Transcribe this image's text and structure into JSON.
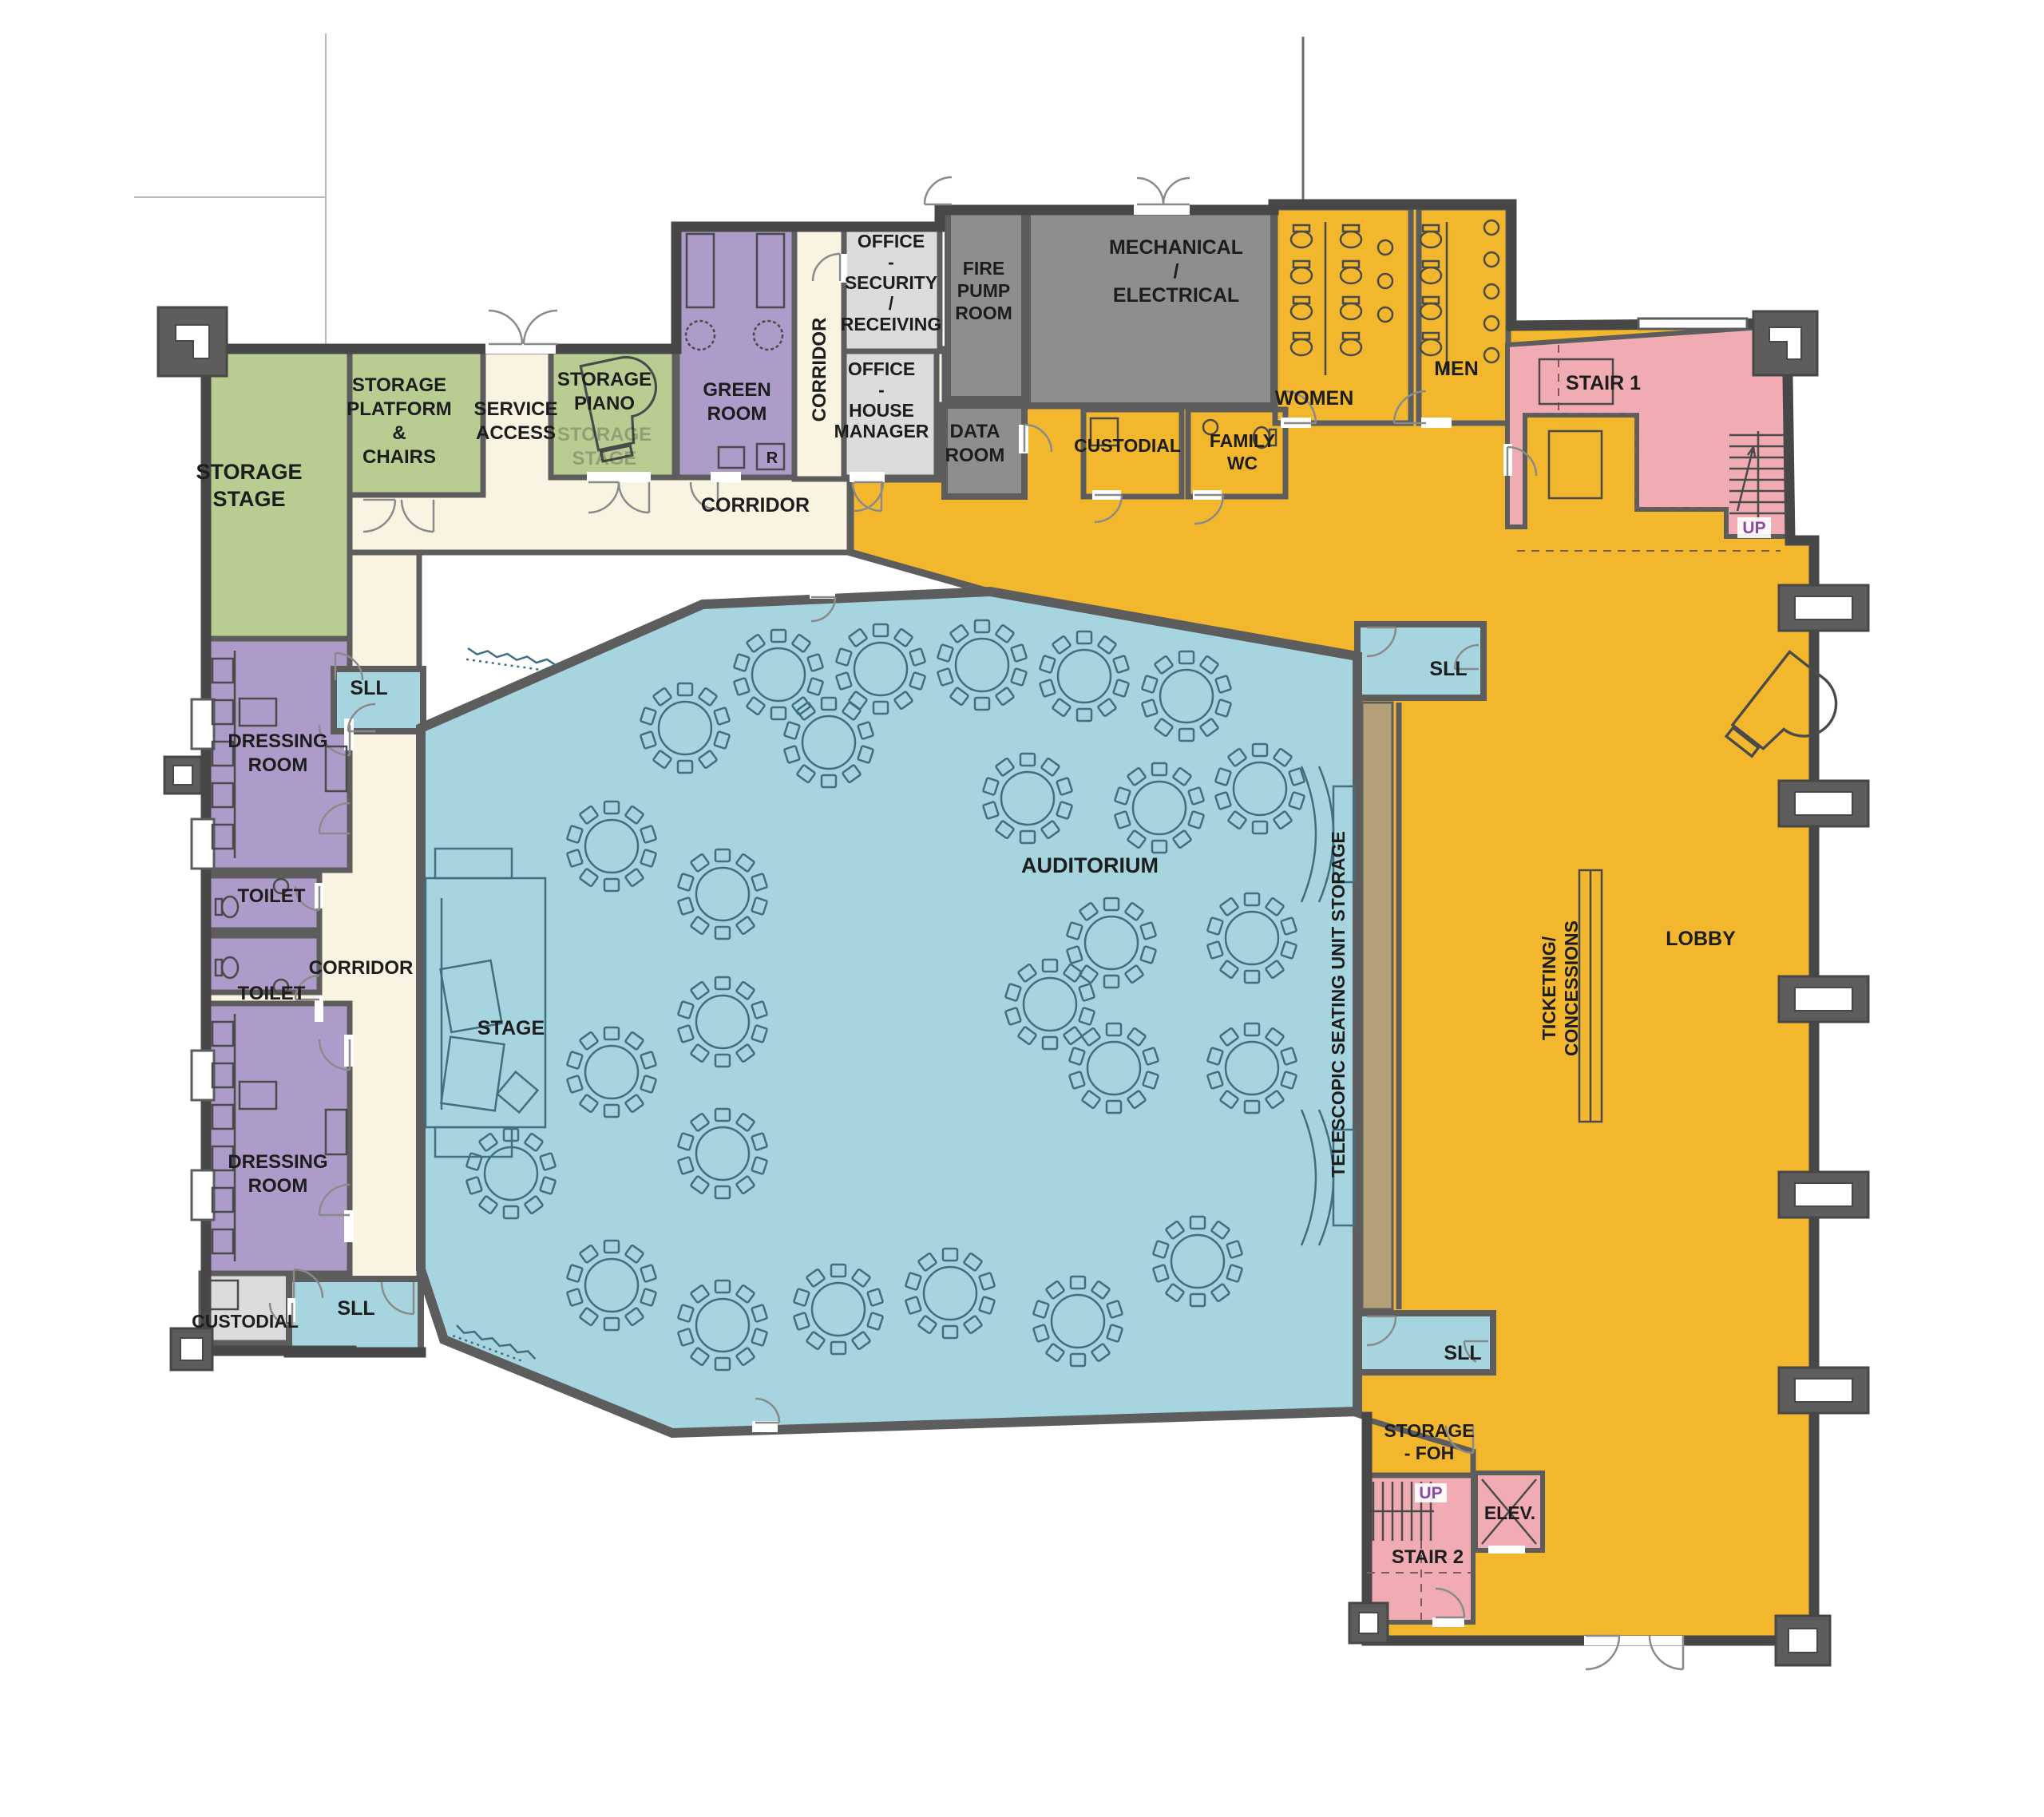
{
  "title": "Auditorium / performing arts center ground floor plan",
  "colors": {
    "wall": "#5d5d5d",
    "wall_dark": "#474747",
    "cream": "#f8f4e1",
    "green": "#b9cd92",
    "purple": "#ad9cc9",
    "gray_light": "#dcdcdc",
    "gray_dark": "#8e8e8e",
    "yellow": "#f3b72d",
    "pink": "#f1abb3",
    "blue": "#a6d5df",
    "tan": "#b3a077",
    "label": "#1d1d1d",
    "up": "#8b4a9e",
    "furn_blue": "#3f6f80",
    "furn_dark": "#4a4a4a"
  },
  "rooms": {
    "storage_stage": {
      "lines": [
        "STORAGE",
        "STAGE"
      ]
    },
    "storage_platform": {
      "lines": [
        "STORAGE",
        "PLATFORM",
        "&",
        "CHAIRS"
      ]
    },
    "service_access": {
      "lines": [
        "SERVICE",
        "ACCESS"
      ]
    },
    "storage_piano": {
      "lines": [
        "STORAGE",
        "PIANO"
      ]
    },
    "storage_piano_ghost": {
      "lines": [
        "STORAGE",
        "STAGE"
      ]
    },
    "green_room": {
      "lines": [
        "GREEN",
        "ROOM"
      ]
    },
    "office_security": {
      "lines": [
        "OFFICE",
        "-",
        "SECURITY",
        "/",
        "RECEIVING"
      ]
    },
    "office_house_manager": {
      "lines": [
        "OFFICE",
        "-",
        "HOUSE",
        "MANAGER"
      ]
    },
    "corridor": {
      "label": "CORRIDOR"
    },
    "fire_pump": {
      "lines": [
        "FIRE",
        "PUMP",
        "ROOM"
      ]
    },
    "mechanical": {
      "lines": [
        "MECHANICAL",
        "/",
        "ELECTRICAL"
      ]
    },
    "data_room": {
      "lines": [
        "DATA",
        "ROOM"
      ]
    },
    "custodial": {
      "label": "CUSTODIAL"
    },
    "family_wc": {
      "lines": [
        "FAMILY",
        "WC"
      ]
    },
    "women": {
      "label": "WOMEN"
    },
    "men": {
      "label": "MEN"
    },
    "stair1": {
      "label": "STAIR 1"
    },
    "up": {
      "label": "UP"
    },
    "dressing_room": {
      "lines": [
        "DRESSING",
        "ROOM"
      ]
    },
    "toilet": {
      "label": "TOILET"
    },
    "sll": {
      "label": "SLL"
    },
    "stage": {
      "label": "STAGE"
    },
    "auditorium": {
      "label": "AUDITORIUM"
    },
    "telescopic": {
      "label": "TELESCOPIC SEATING UNIT STORAGE"
    },
    "ticketing": {
      "lines": [
        "TICKETING/",
        "CONCESSIONS"
      ]
    },
    "lobby": {
      "label": "LOBBY"
    },
    "storage_foh": {
      "lines": [
        "STORAGE",
        "- FOH"
      ]
    },
    "stair2": {
      "label": "STAIR 2"
    },
    "elev": {
      "label": "ELEV."
    },
    "fridge": {
      "label": "R"
    }
  },
  "furniture": {
    "auditorium_round_tables": 27,
    "seats_per_table": 10,
    "grand_pianos": 2
  }
}
